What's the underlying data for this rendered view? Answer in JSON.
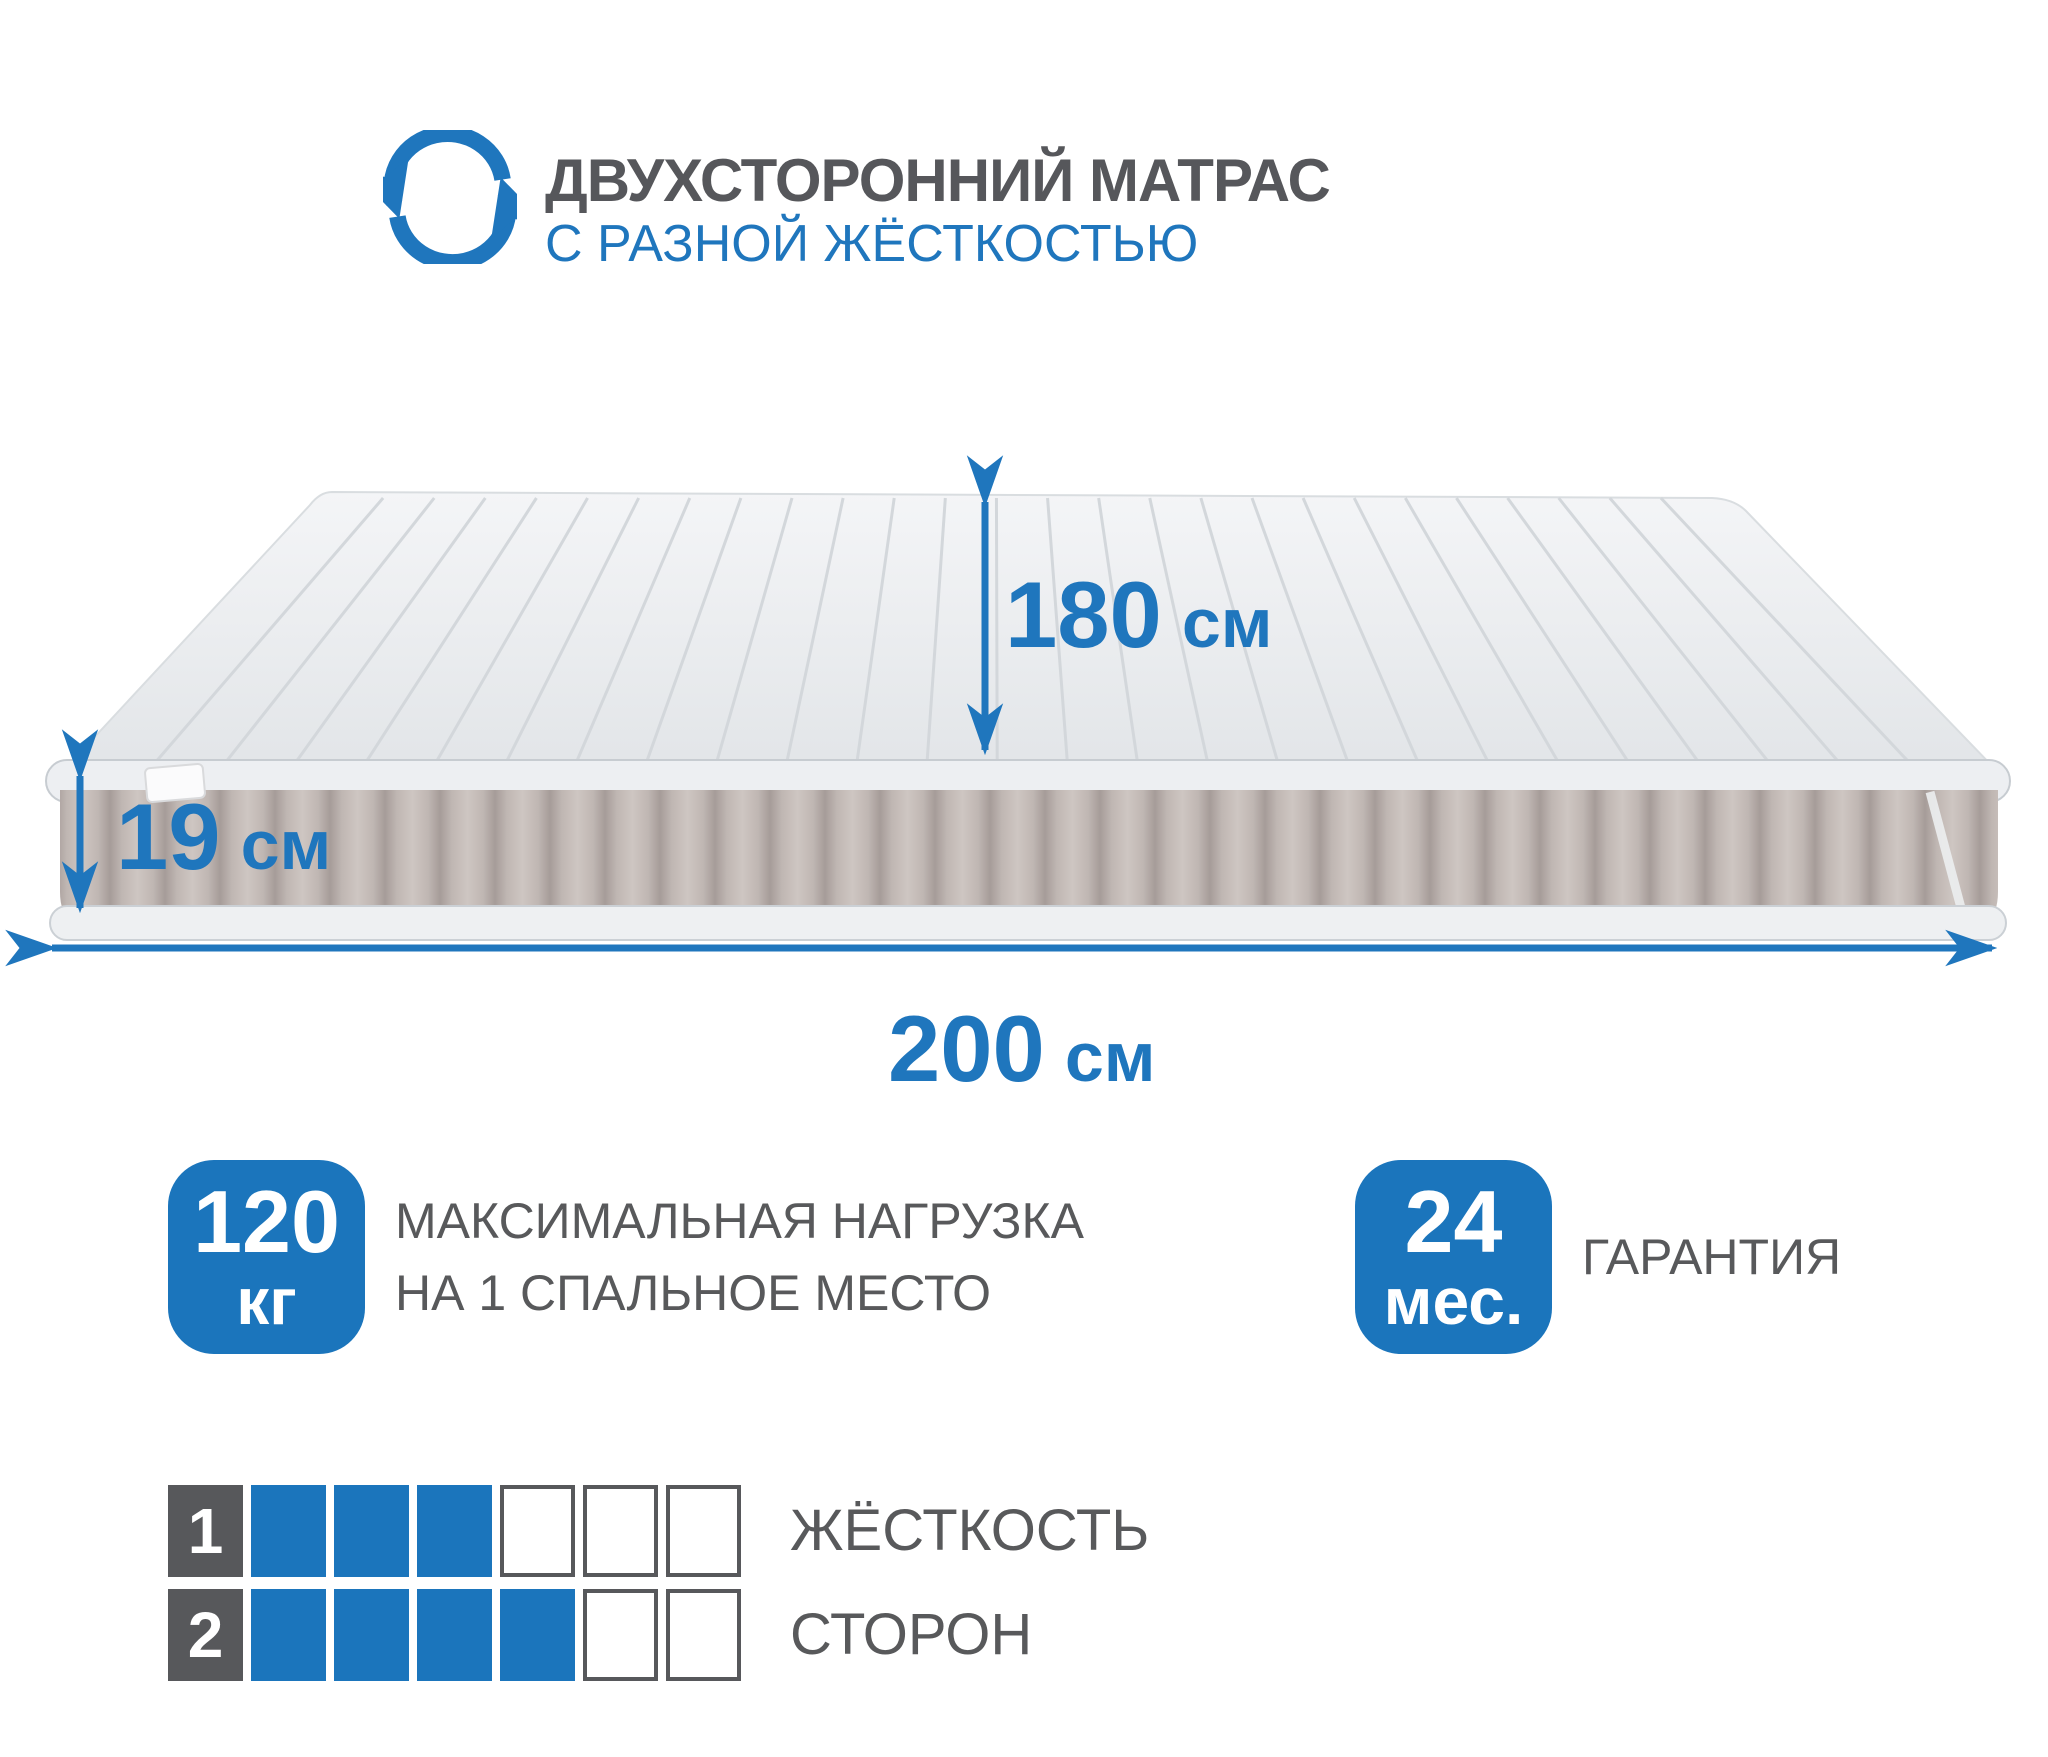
{
  "colors": {
    "accent_blue": "#1b75bc",
    "text_gray": "#58595b",
    "mattress_top": "#eceff1",
    "mattress_side": "#c0b7b3",
    "piping": "#edeff2"
  },
  "header": {
    "icon": "rotate-arrows-icon",
    "title": "ДВУХСТОРОННИЙ МАТРАС",
    "subtitle": "С РАЗНОЙ ЖЁСТКОСТЬЮ"
  },
  "mattress": {
    "width": {
      "value": "180",
      "unit": "см"
    },
    "height": {
      "value": "19",
      "unit": "см"
    },
    "length": {
      "value": "200",
      "unit": "см"
    }
  },
  "features": [
    {
      "badge_value": "120",
      "badge_unit": "кг",
      "label_lines": [
        "МАКСИМАЛЬНАЯ НАГРУЗКА",
        "НА 1 СПАЛЬНОЕ МЕСТО"
      ]
    },
    {
      "badge_value": "24",
      "badge_unit": "мес.",
      "label_lines": [
        "ГАРАНТИЯ"
      ]
    }
  ],
  "firmness": {
    "scale_max": 6,
    "rows": [
      {
        "side": "1",
        "filled": 3
      },
      {
        "side": "2",
        "filled": 4
      }
    ],
    "label_lines": [
      "ЖЁСТКОСТЬ",
      "СТОРОН"
    ]
  }
}
